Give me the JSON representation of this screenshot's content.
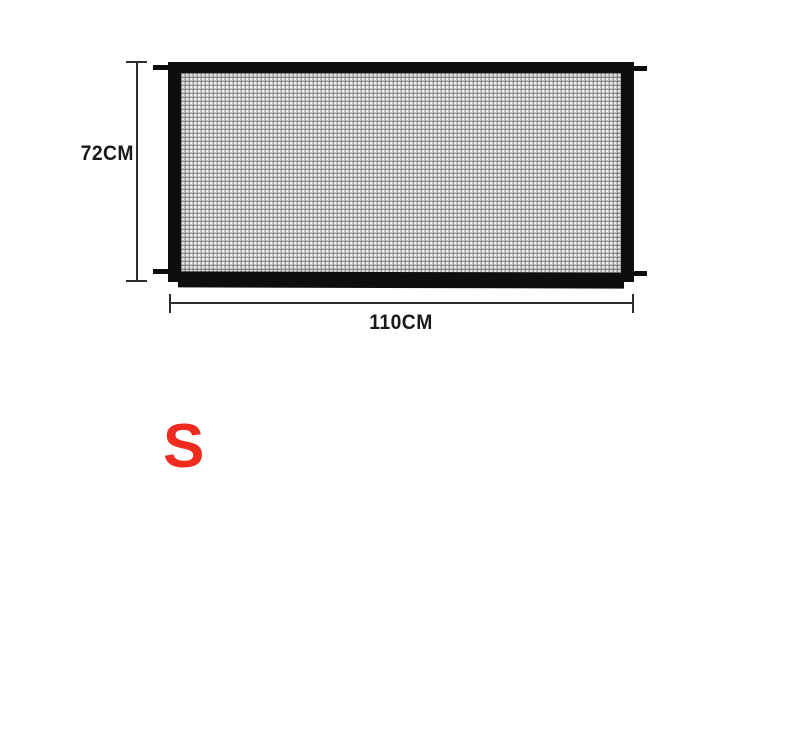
{
  "diagram": {
    "product": "mesh-safety-gate",
    "height_label": "72CM",
    "width_label": "110CM",
    "size_label": "S",
    "colors": {
      "frame": "#0e0e0e",
      "mesh_base": "#c3c5c6",
      "dimension": "#2d2d2d",
      "size_red": "#ee2b1e"
    }
  }
}
